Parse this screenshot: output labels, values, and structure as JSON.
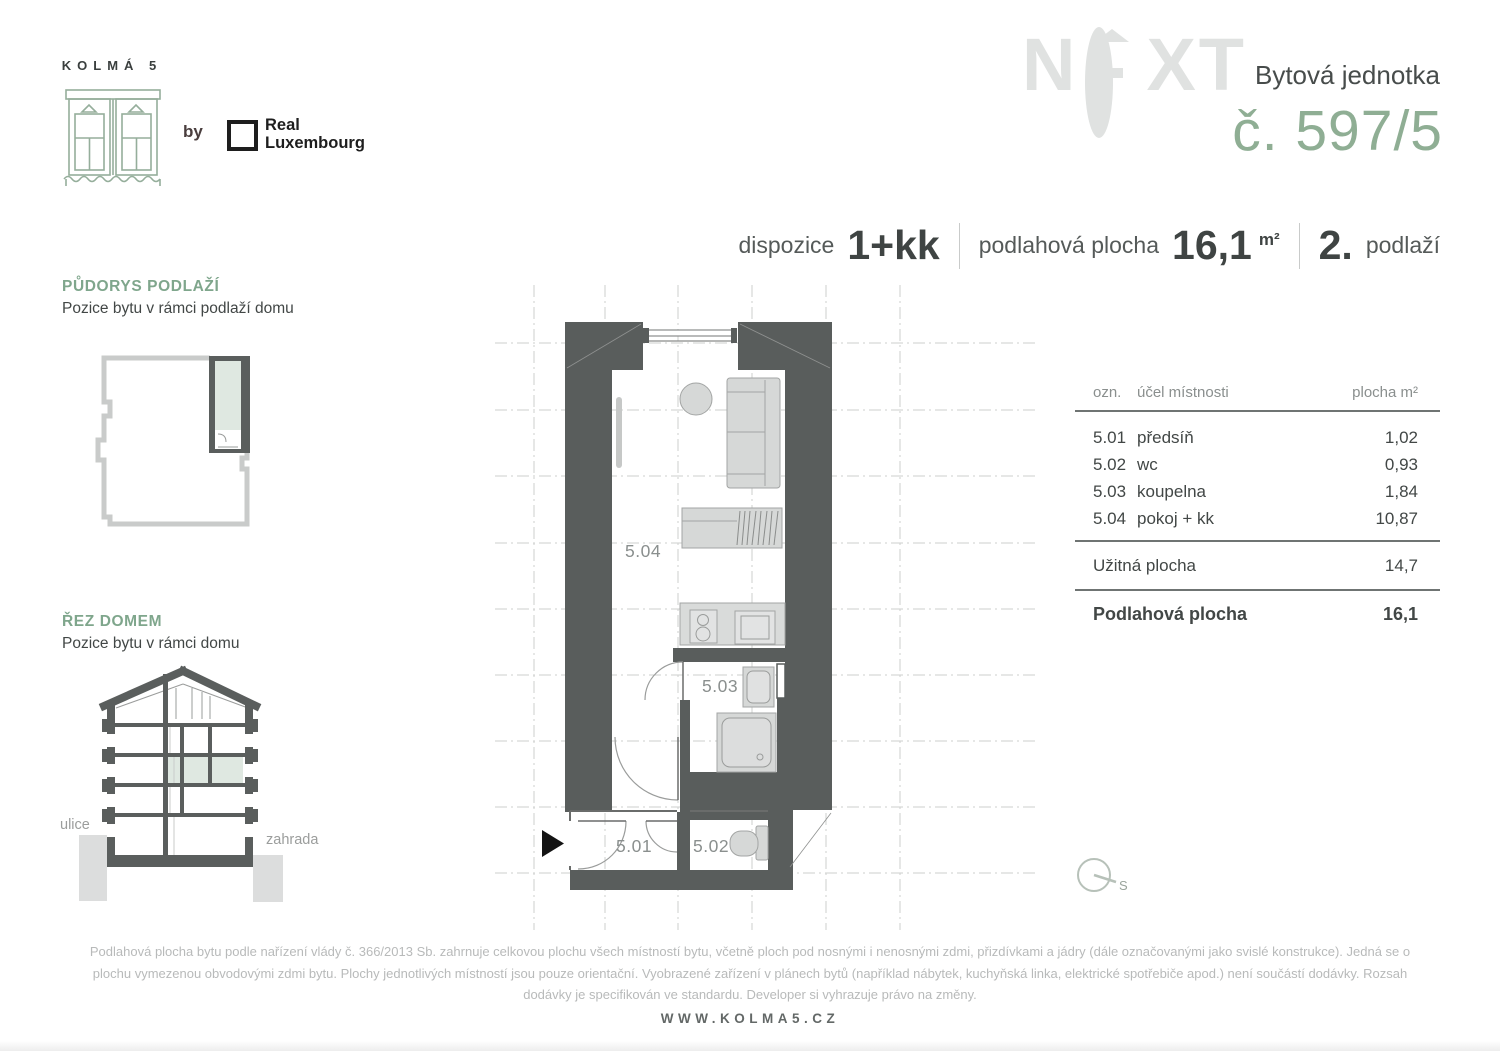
{
  "brand": {
    "name": "KOLMÁ 5",
    "by": "by",
    "partner_line1": "Real",
    "partner_line2": "Luxembourg"
  },
  "header": {
    "watermark_n": "N",
    "watermark_xt": "XT",
    "unit_type_label": "Bytová jednotka",
    "unit_number": "č. 597/5"
  },
  "specs": {
    "dispozice_label": "dispozice",
    "dispozice_value": "1+kk",
    "area_label": "podlahová plocha",
    "area_value": "16,1",
    "area_unit": "m²",
    "floor_value": "2.",
    "floor_label": "podlaží"
  },
  "sidebar": {
    "floorplan_title": "PŮDORYS PODLAŽÍ",
    "floorplan_subtitle": "Pozice bytu v rámci podlaží domu",
    "section_title": "ŘEZ DOMEM",
    "section_subtitle": "Pozice bytu v rámci domu",
    "street_label": "ulice",
    "garden_label": "zahrada"
  },
  "plan": {
    "room_504": "5.04",
    "room_503": "5.03",
    "room_501": "5.01",
    "room_502": "5.02",
    "compass_label": "S"
  },
  "table": {
    "headers": [
      "ozn.",
      "účel místnosti",
      "plocha m²"
    ],
    "rows": [
      {
        "id": "5.01",
        "name": "předsíň",
        "area": "1,02"
      },
      {
        "id": "5.02",
        "name": "wc",
        "area": "0,93"
      },
      {
        "id": "5.03",
        "name": "koupelna",
        "area": "1,84"
      },
      {
        "id": "5.04",
        "name": "pokoj + kk",
        "area": "10,87"
      }
    ],
    "usable_label": "Užitná plocha",
    "usable_value": "14,7",
    "total_label": "Podlahová plocha",
    "total_value": "16,1"
  },
  "footer": {
    "disclaimer": "Podlahová plocha bytu podle nařízení vlády č. 366/2013 Sb. zahrnuje celkovou plochu všech místností bytu, včetně ploch pod nosnými i nenosnými zdmi, přizdívkami a jádry (dále označovanými jako svislé konstrukce). Jedná se o plochu vymezenou obvodovými zdmi bytu. Plochy jednotlivých místností jsou pouze orientační. Vyobrazené zařízení v plánech bytů (například nábytek, kuchyňská linka, elektrické spotřebiče apod.) není součástí dodávky. Rozsah dodávky je specifikován ve standardu. Developer si vyhrazuje právo na změny.",
    "website": "WWW.KOLMA5.CZ"
  },
  "colors": {
    "accent_green": "#7fa68c",
    "unit_number_green": "#8fae94",
    "pale_green_fill": "#dfe8e1",
    "wall_gray": "#595d5c",
    "text_dark": "#3f4443",
    "watermark_gray": "#e0e2e1"
  }
}
